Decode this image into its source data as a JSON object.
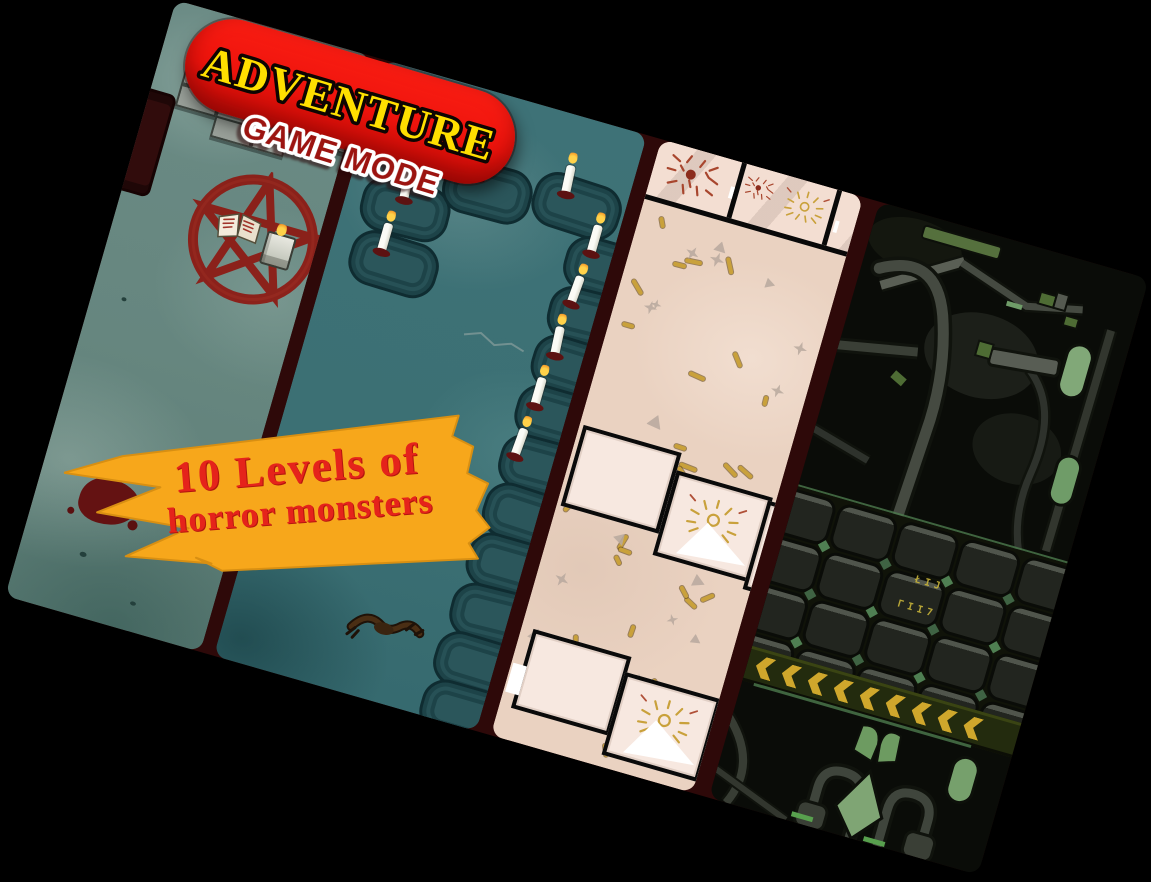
{
  "page": {
    "background": "#000000"
  },
  "badge": {
    "title": "ADVENTURE",
    "subtitle": "GAME MODE"
  },
  "banner": {
    "line1": "10 Levels of",
    "line2": "horror monsters"
  },
  "panel4": {
    "glyphs_line1": "ŁIJ",
    "glyphs_line2": "ΓII7"
  },
  "colors": {
    "page-black": "#000000",
    "badge-red": "#ed130c",
    "adventure-yellow": "#ffdf00",
    "gamemode-red": "#9c1410",
    "gamemode-outline": "#ffffff",
    "banner-yellow": "#f7a71b",
    "banner-text-red": "#e5231b",
    "separator-maroon": "#2e0909",
    "panel1-teal": "#66867f",
    "panel2-teal": "#3c7074",
    "panel3-beige": "#ead2c1",
    "panel3-wall": "#f3ded2",
    "panel3-cell": "#f7e8e0",
    "panel4-black": "#0a0c08",
    "pentagram-red": "#8e1812",
    "slab-teal": "#2b565b",
    "candle-white": "#f1f1ea",
    "flame-orange": "#f59d2a",
    "blood-red": "#5f1111",
    "stone-grey": "#99a099",
    "debris-gold": "#c9a13b",
    "sparkle-grey": "#b7a89e",
    "tile-dark": "#22251f",
    "tile-light": "#50554c",
    "diamond-green": "#4f7f52",
    "glyph-yellow": "#c8b43a",
    "hazard-yellow": "#cfa72c",
    "hazard-olive": "#232b0e",
    "pipe-grey": "#454a41",
    "accent-green": "#76a06c",
    "tree-brown": "#4a2e14"
  }
}
